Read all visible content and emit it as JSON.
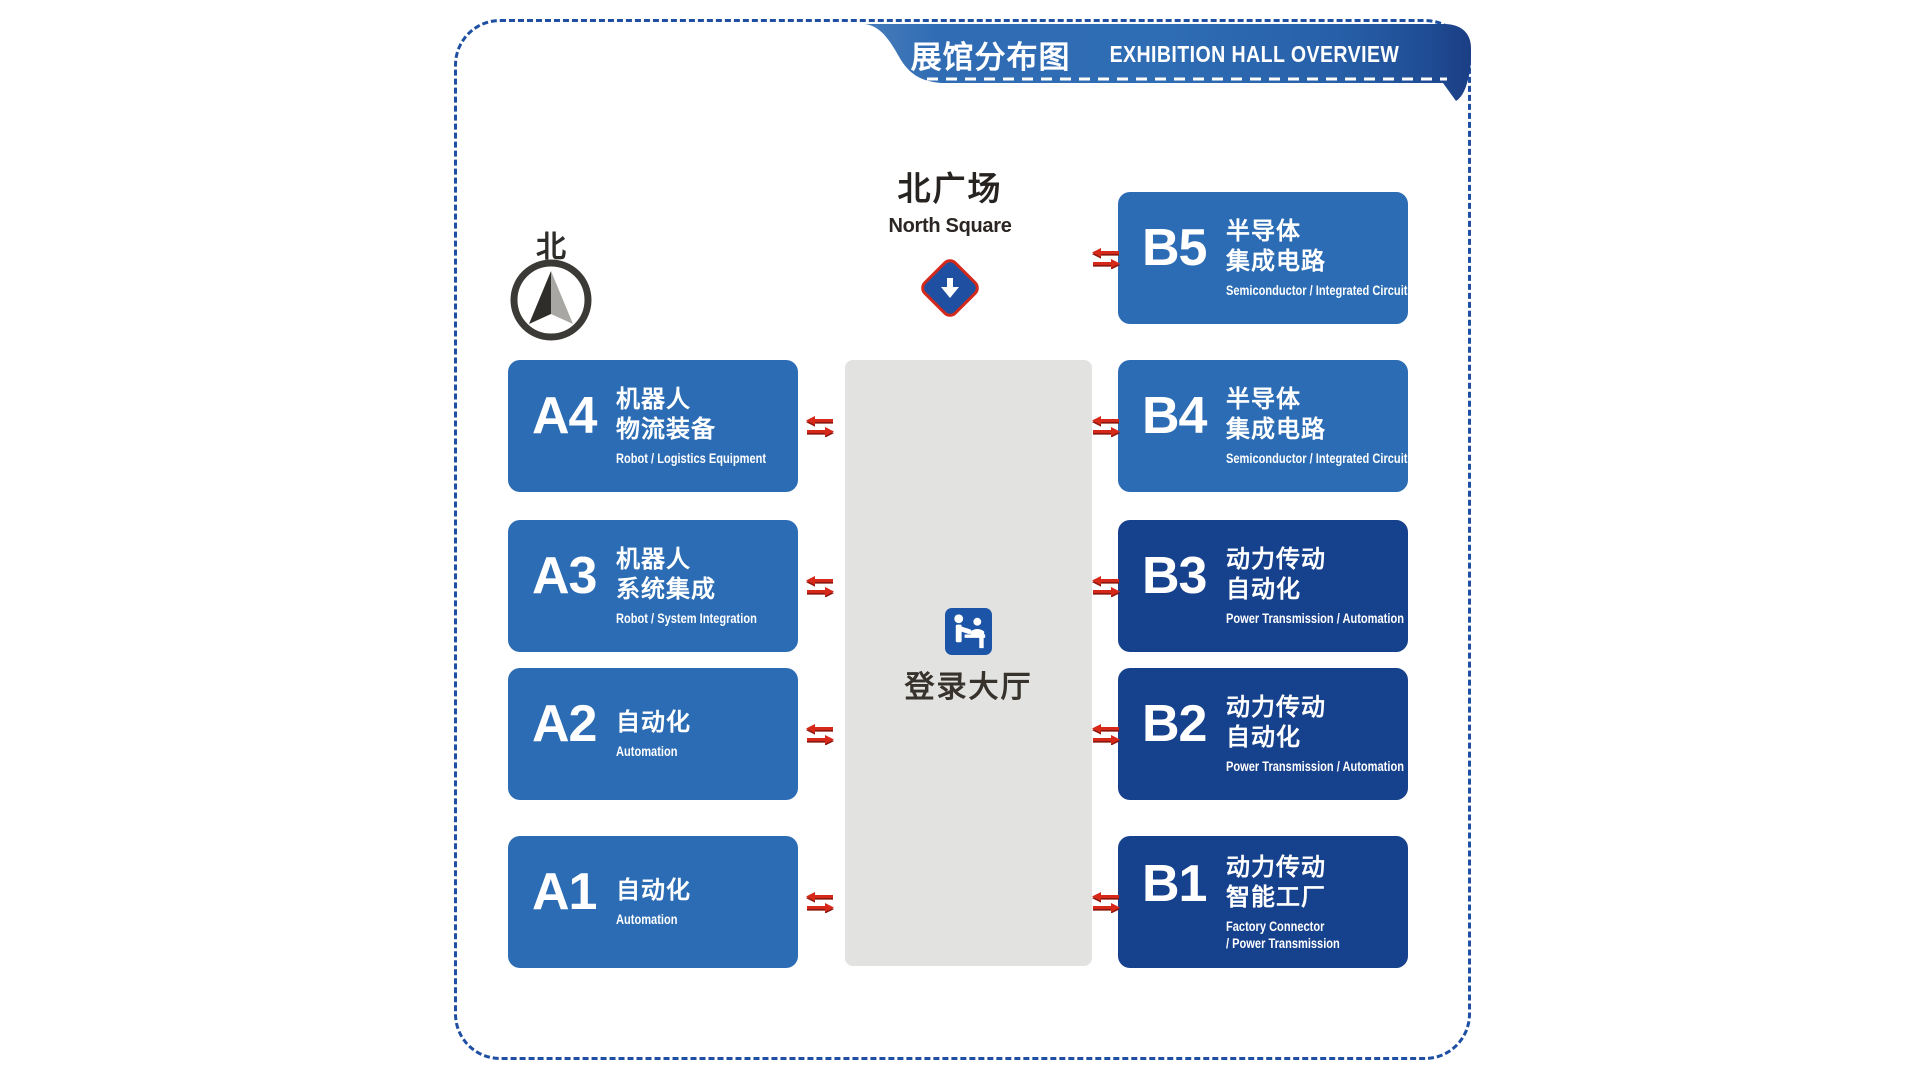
{
  "banner": {
    "title_cn": "展馆分布图",
    "title_en": "EXHIBITION HALL OVERVIEW"
  },
  "north_square": {
    "label_cn": "北广场",
    "label_en": "North Square"
  },
  "compass": {
    "label": "北"
  },
  "registration_hall": {
    "label": "登录大厅"
  },
  "halls": {
    "left": [
      {
        "code": "A4",
        "cn": [
          "机器人",
          "物流装备"
        ],
        "en": [
          "Robot / Logistics Equipment"
        ]
      },
      {
        "code": "A3",
        "cn": [
          "机器人",
          "系统集成"
        ],
        "en": [
          "Robot / System Integration"
        ]
      },
      {
        "code": "A2",
        "cn": [
          "自动化"
        ],
        "en": [
          "Automation"
        ]
      },
      {
        "code": "A1",
        "cn": [
          "自动化"
        ],
        "en": [
          "Automation"
        ]
      }
    ],
    "right": [
      {
        "code": "B5",
        "cn": [
          "半导体",
          "集成电路"
        ],
        "en": [
          "Semiconductor / Integrated Circuits"
        ]
      },
      {
        "code": "B4",
        "cn": [
          "半导体",
          "集成电路"
        ],
        "en": [
          "Semiconductor / Integrated Circuits"
        ]
      },
      {
        "code": "B3",
        "cn": [
          "动力传动",
          "自动化"
        ],
        "en": [
          "Power Transmission / Automation"
        ]
      },
      {
        "code": "B2",
        "cn": [
          "动力传动",
          "自动化"
        ],
        "en": [
          "Power Transmission / Automation"
        ]
      },
      {
        "code": "B1",
        "cn": [
          "动力传动",
          "智能工厂"
        ],
        "en": [
          "Factory Connector",
          "/ Power Transmission"
        ]
      }
    ]
  },
  "colors": {
    "hall_medium_blue": "#2b6cb4",
    "hall_dark_blue": "#16418c",
    "border_blue": "#1e4fa3",
    "arrow_red": "#d2291c",
    "aisle_gray": "#e2e2e1",
    "icon_blue": "#1c55a8",
    "banner_blue_left": "#3f74b4",
    "banner_blue_right": "#1b3e84"
  }
}
